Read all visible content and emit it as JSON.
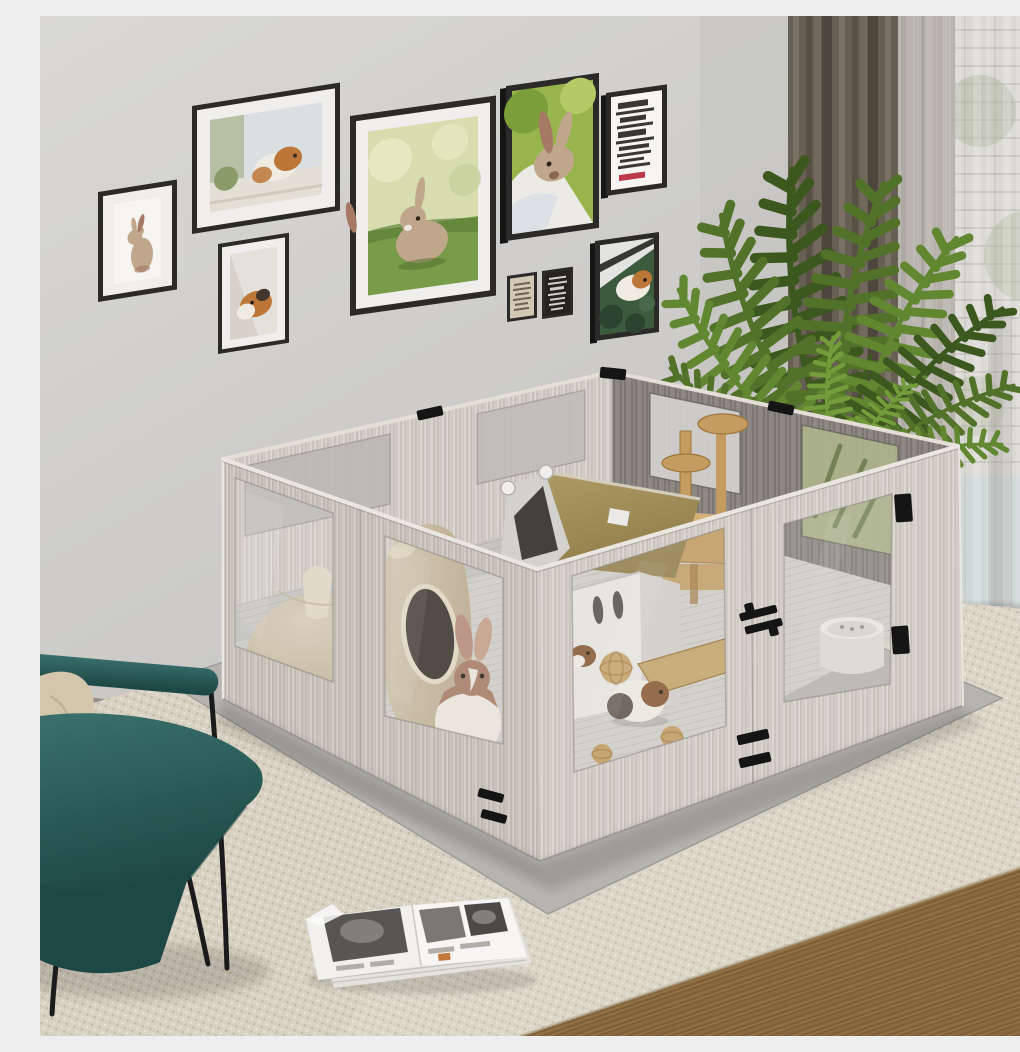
{
  "meta": {
    "type": "product-photo",
    "width": 1020,
    "height": 1020,
    "description": "Lifestyle product photo of a large square DIY small-pet playpen in a bright living room"
  },
  "colors": {
    "wall-top": "#dedddb",
    "wall-bot": "#c7c6c3",
    "wall-shadow": "#b9b8b5",
    "baseboard": "#cfccc8",
    "baseboard-line": "#e6e3df",
    "floor-bare": "#9a928a",
    "rug": "#ded7c8",
    "rug-dark": "#bfb49c",
    "rug-light": "#efe9dc",
    "woodfloor": "#8d6c40",
    "woodfloor-dark": "#6e5230",
    "woodfloor-light": "#a5824f",
    "mat": "#bab8b4",
    "mat-edge": "#a3a19d",
    "wood": "#d6d0c9",
    "wood-grain": "#a2978c",
    "wood-hi": "#efebe5",
    "wood-edge": "#e9e3dc",
    "wood-dark": "#8e8984",
    "wood-dark-grain": "#635e59",
    "floor-in": "#d6d3ce",
    "floor-line": "#b8b4ae",
    "acrylic": "#e8e6e2",
    "acrylic-edge": "#8d8882",
    "frame": "#2c2b2a",
    "frame-side": "#171616",
    "frame-mat": "#f4f3f1",
    "photo-bg": "#fbfaf7",
    "grass": "#7ba04b",
    "grass-dark": "#5d8037",
    "bokeh": "#dde2b4",
    "bokeh2": "#ebefc6",
    "leaf-bg": "#3e5c40",
    "leaf-dark": "#2c4530",
    "gp-orange": "#c07a3a",
    "gp-white": "#f4f0e8",
    "gp-dark": "#45392e",
    "gp-brown": "#8a5a33",
    "rabbit": "#c4ab8e",
    "rabbit2": "#a97c66",
    "rabbit-cream": "#f1ece4",
    "text-dark": "#3a3936",
    "text-light": "#d8d6d2",
    "accent-red": "#c23b4e",
    "poster-beige": "#d8cdb9",
    "poster-black": "#252423",
    "poster-text": "#6b6253",
    "curtain": "#6b6156",
    "curtain-dark": "#4f473e",
    "curtain-light": "#80766a",
    "sheer": "#f0efec",
    "blind-bg": "#c6c2ba",
    "blind-line": "#827d74",
    "glass": "#9dc0c4",
    "out-green": "#6e7e48",
    "plant-a": "#3f5a1f",
    "plant-b": "#54742a",
    "plant-c": "#648a32",
    "plant-d": "#76a03c",
    "teal": "#2e615e",
    "teal-dark": "#1f4a47",
    "teal-hi": "#3d736f",
    "pillow": "#d9cab1",
    "pillow-dark": "#c3b296",
    "leg": "#1c1c1c",
    "dome": "#ddd1bc",
    "dome-dark": "#c5b59c",
    "jar": "#d8cbb4",
    "jar-dark": "#bfae92",
    "hole": "#352f29",
    "tent-roof": "#94804c",
    "tent-roof-hi": "#b3a068",
    "tent-frame": "#d8d6d2",
    "tent-inner": "#46423c",
    "toy": "#c89f63",
    "toy-dark": "#a2793f",
    "house": "#edebe7",
    "house-side": "#d8d5d0",
    "house-trim": "#c9a86b",
    "slot": "#55504a",
    "bowl": "#f0eeea",
    "bowl-side": "#e2dfda",
    "hw": "#161616",
    "mag-page": "#f6f5f2",
    "mag-photo": "#5a5856",
    "mag-photo2": "#7d7b78",
    "mag-accent": "#c77b3e"
  },
  "room": {
    "wall": "light gray painted wall",
    "baseboard": "pale gray skirting board",
    "rug": "beige woven area rug",
    "floor": "brown wood plank flooring visible at lower right"
  },
  "gallery": {
    "description": "gallery wall of nine black-framed small-pet prints",
    "frames": [
      {
        "id": "standing-rabbit",
        "description": "beige rabbit standing upright on white"
      },
      {
        "id": "guinea-pig-window",
        "description": "orange and white guinea pig on a windowsill"
      },
      {
        "id": "guinea-pig-portrait",
        "description": "orange and black guinea pig on pale bedding"
      },
      {
        "id": "rabbit-on-grass",
        "description": "brown baby rabbit sitting on green grass"
      },
      {
        "id": "rabbit-held",
        "description": "brown rabbit against green and white"
      },
      {
        "id": "typography-poster",
        "description": "white poster with dense black serif text and a red word (illegible)"
      },
      {
        "id": "mini-beige-poster",
        "description": "small beige quote print (illegible)"
      },
      {
        "id": "mini-black-poster",
        "description": "small black quote print with light text (illegible)"
      },
      {
        "id": "guinea-pig-greens",
        "description": "white and orange guinea pig among dark green leaves with a diagonal ramp"
      }
    ]
  },
  "window_area": {
    "dark_curtain": "floor-length taupe-brown blackout curtain",
    "sheer_curtain": "white voile sheer curtain",
    "view": "window with blinds, greenery and teal sky glimpses"
  },
  "plant": {
    "id": "areca-palm",
    "description": "tall areca palm with arching feathered fronds",
    "frond_count": 12
  },
  "playpen": {
    "description": "large square small-pet playpen of white-washed oak-grain panels with clear acrylic windows",
    "materials": {
      "panel": "white-washed wood grain board",
      "window": "clear acrylic",
      "hardware": "black metal clips, hinges and slot vents",
      "base": "gray floor mat"
    },
    "walls": {
      "front_left": {
        "panels": 2,
        "windows": 2
      },
      "front_right": {
        "panels": 2,
        "windows": 2
      },
      "back_left": {
        "panels": 2,
        "windows": 2
      },
      "back_right": {
        "panels": 2,
        "windows": 2
      }
    },
    "accessories": [
      {
        "id": "dome-hideout",
        "description": "beige dome igloo hideout"
      },
      {
        "id": "jar-hideout",
        "description": "tilted jar-shaped hideout with round opening"
      },
      {
        "id": "tent-house",
        "description": "tent house with olive fabric roof and white frame"
      },
      {
        "id": "cat-tree",
        "description": "natural wood tree with two round perches"
      },
      {
        "id": "white-hideout-house",
        "description": "white hideout house with oval openings and wood trim"
      },
      {
        "id": "wood-ramp",
        "description": "wooden ramp board on the floor"
      },
      {
        "id": "rattan-balls",
        "description": "rattan chew balls",
        "count": 3
      },
      {
        "id": "food-bowl",
        "description": "round white food bowl"
      }
    ],
    "animals": [
      {
        "id": "rabbit",
        "description": "brown and white rabbit at the front-left window"
      },
      {
        "id": "guinea-pig-center",
        "description": "white, tan and black guinea pig in the middle"
      },
      {
        "id": "guinea-pig-peeking",
        "description": "brown guinea pig peeking near the front corner"
      }
    ]
  },
  "furniture": {
    "armchair": {
      "description": "teal leather lounge chair with black metal legs",
      "cushion": "beige throw pillow"
    },
    "magazine": {
      "description": "open magazine with black-and-white spreads lying on the rug"
    }
  },
  "a11y": {
    "caption": "Living room with a large square white-oak small-pet playpen with acrylic windows holding rabbits and guinea pigs, below a gallery wall of pet prints, beside a palm plant, curtained window, teal armchair and an open magazine on a woven rug."
  }
}
